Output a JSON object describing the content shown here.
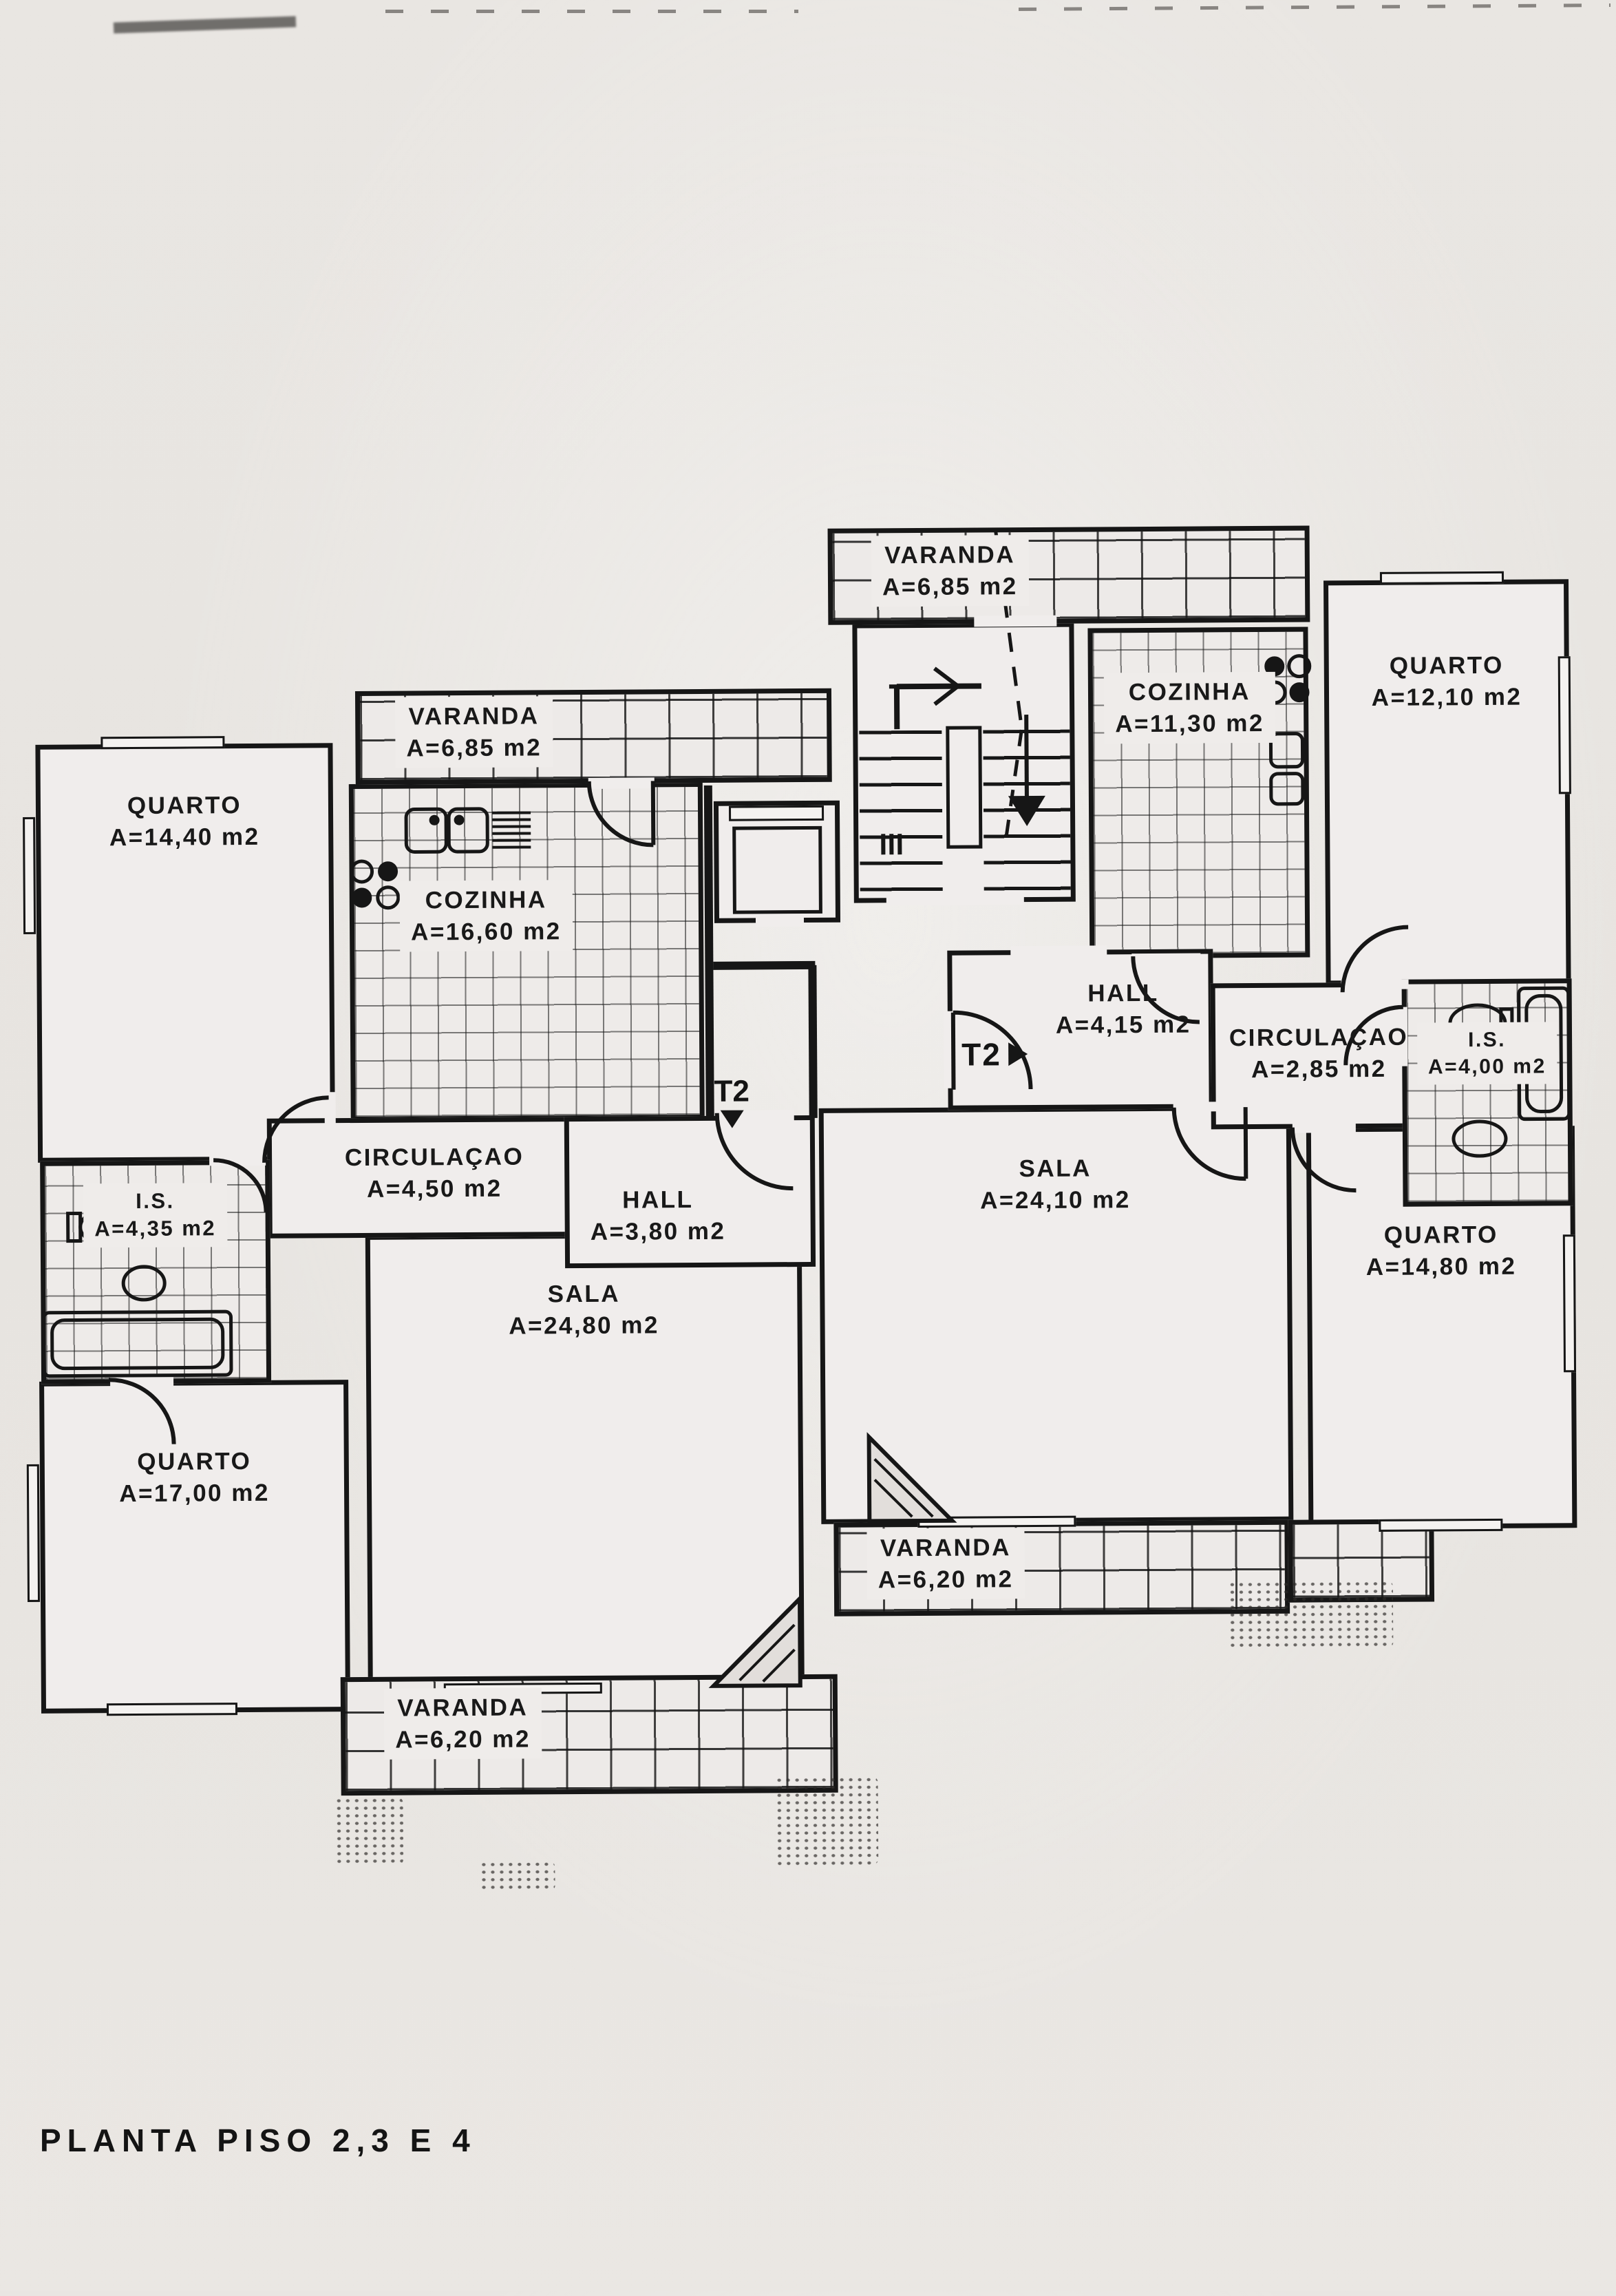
{
  "title": "PLANTA PISO 2,3 E 4",
  "markers": {
    "t2_right": "T2",
    "t2_down": "T2"
  },
  "rooms": {
    "varanda_top": {
      "name": "VARANDA",
      "area": "A=6,85 m2"
    },
    "quarto_ne": {
      "name": "QUARTO",
      "area": "A=12,10 m2"
    },
    "cozinha_right": {
      "name": "COZINHA",
      "area": "A=11,30 m2"
    },
    "varanda_left": {
      "name": "VARANDA",
      "area": "A=6,85 m2"
    },
    "quarto_nw": {
      "name": "QUARTO",
      "area": "A=14,40 m2"
    },
    "cozinha_left": {
      "name": "COZINHA",
      "area": "A=16,60 m2"
    },
    "hall_right": {
      "name": "HALL",
      "area": "A=4,15 m2"
    },
    "circulacao_right": {
      "name": "CIRCULAÇAO",
      "area": "A=2,85 m2"
    },
    "is_right": {
      "name": "I.S.",
      "area": "A=4,00 m2"
    },
    "circulacao_left": {
      "name": "CIRCULAÇAO",
      "area": "A=4,50 m2"
    },
    "hall_left": {
      "name": "HALL",
      "area": "A=3,80 m2"
    },
    "sala_right": {
      "name": "SALA",
      "area": "A=24,10 m2"
    },
    "is_left": {
      "name": "I.S.",
      "area": "A=4,35 m2"
    },
    "sala_left": {
      "name": "SALA",
      "area": "A=24,80 m2"
    },
    "quarto_se": {
      "name": "QUARTO",
      "area": "A=14,80 m2"
    },
    "quarto_sw": {
      "name": "QUARTO",
      "area": "A=17,00 m2"
    },
    "varanda_bot_center": {
      "name": "VARANDA",
      "area": "A=6,20 m2"
    },
    "varanda_bot_left": {
      "name": "VARANDA",
      "area": "A=6,20 m2"
    }
  }
}
